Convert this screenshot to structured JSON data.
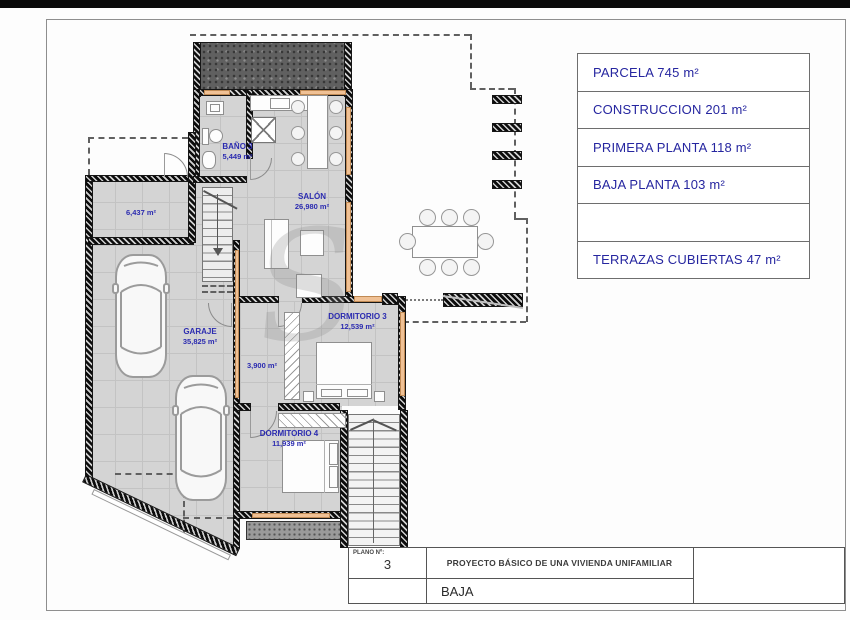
{
  "info_panel": {
    "rows": [
      "PARCELA 745 m²",
      "CONSTRUCCION 201 m²",
      "PRIMERA PLANTA 118 m²",
      "BAJA PLANTA 103 m²",
      "",
      "TERRAZAS CUBIERTAS 47 m²"
    ]
  },
  "title_block": {
    "plano_label": "PLANO Nº:",
    "plano_number": "3",
    "project_title": "PROYECTO BÁSICO DE UNA VIVIENDA UNIFAMILIAR",
    "floor_name": "BAJA"
  },
  "rooms": {
    "bano3": {
      "name": "BAÑO 3",
      "area": "5,449 m²"
    },
    "salon": {
      "name": "SALÓN",
      "area": "26,980 m²"
    },
    "trastero": {
      "area": "6,437 m²"
    },
    "garaje": {
      "name": "GARAJE",
      "area": "35,825 m²"
    },
    "pasillo": {
      "area": "3,900 m²"
    },
    "dormitorio3": {
      "name": "DORMITORIO 3",
      "area": "12,539 m²"
    },
    "dormitorio4": {
      "name": "DORMITORIO 4",
      "area": "11,939 m²"
    }
  },
  "watermark": "S",
  "colors": {
    "label_blue": "#2b2bb0",
    "panel_text": "#2626a0",
    "window_orange": "#f0c195"
  }
}
